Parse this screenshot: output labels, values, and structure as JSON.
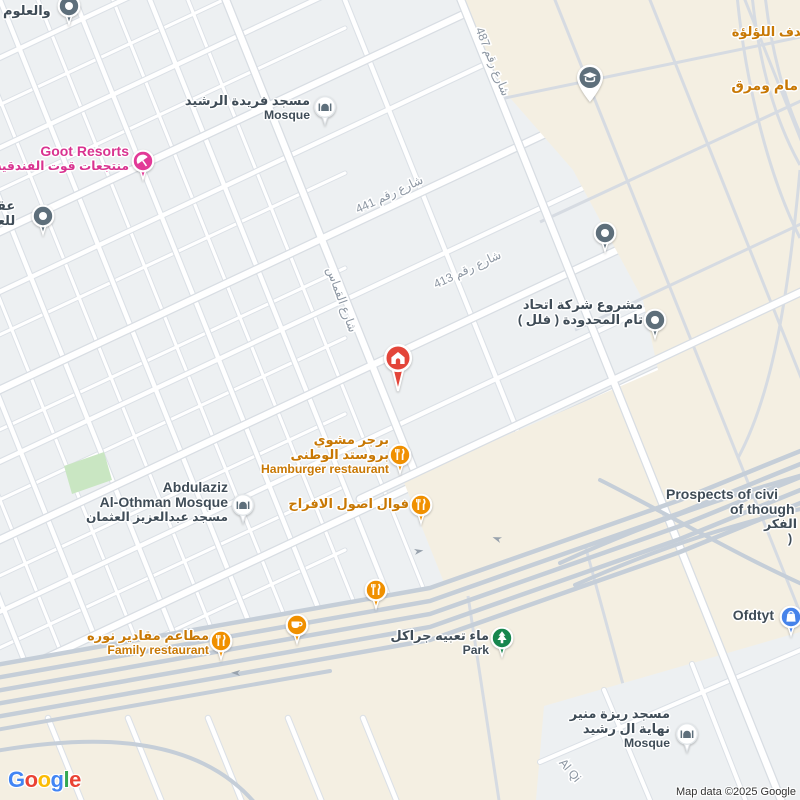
{
  "attribution": "Map data ©2025 Google",
  "logo": {
    "l0": "G",
    "l1": "o",
    "l2": "o",
    "l3": "g",
    "l4": "l",
    "l5": "e"
  },
  "streets": {
    "s487": "شارع رقم 487",
    "s441": "شارع رقم 441",
    "s413": "شارع رقم 413",
    "qammas": "شارع القماس",
    "alqi": "Al Qi"
  },
  "pois": {
    "aloloum": {
      "name": "والعلوم"
    },
    "farida": {
      "ar": "مسجد فريدة الرشيد",
      "en": "Mosque"
    },
    "goot": {
      "en": "Goot Resorts",
      "ar": "منتجعات قوت الفندقية"
    },
    "aqar": {
      "l1": "عقو",
      "l2": "للعق"
    },
    "sadaf": {
      "name": "صدف اللؤلؤة"
    },
    "mamwamaraq": {
      "name": "مام ومرق"
    },
    "mashrou": {
      "l1": "مشروع شركة اتحاد",
      "l2": "تام المحدودة ( فلل )"
    },
    "burger": {
      "l1": "برجر مشوي",
      "l2": "بروستد الوطنى",
      "l3": "Hamburger restaurant"
    },
    "fawal": {
      "name": "فوال اصول الافراح"
    },
    "abdulaziz": {
      "l1": "Abdulaziz",
      "l2": "Al-Othman Mosque",
      "l3": "مسجد عبدالعزيز العثمان"
    },
    "maqadeer": {
      "l1": "مطاعم مقادير نوره",
      "l2": "Family restaurant"
    },
    "park": {
      "l1": "ماء تعبيه جراكل",
      "l2": "Park"
    },
    "prospects": {
      "l1": "Prospects of civi",
      "l2": "of though",
      "l3": "الفكر",
      "l4": ")"
    },
    "ofdtyt": {
      "name": "Ofdtyt"
    },
    "reza": {
      "l1": "مسجد ريزة منير",
      "l2": "نهاية ال رشيد",
      "l3": "Mosque"
    }
  },
  "colors": {
    "poi_orange": "#F09000",
    "label_orange": "#C87804",
    "poi_pink": "#E23A97",
    "poi_green": "#17864E",
    "poi_blue": "#4683EA",
    "poi_slate": "#5E6F7B",
    "marker_red": "#E3453A",
    "beige_zone": "#F4EFE2",
    "block_gray": "#EDF0F2",
    "highway": "#C5CED8",
    "dark_label": "#3F4C57",
    "street_label": "#8C96A2"
  }
}
